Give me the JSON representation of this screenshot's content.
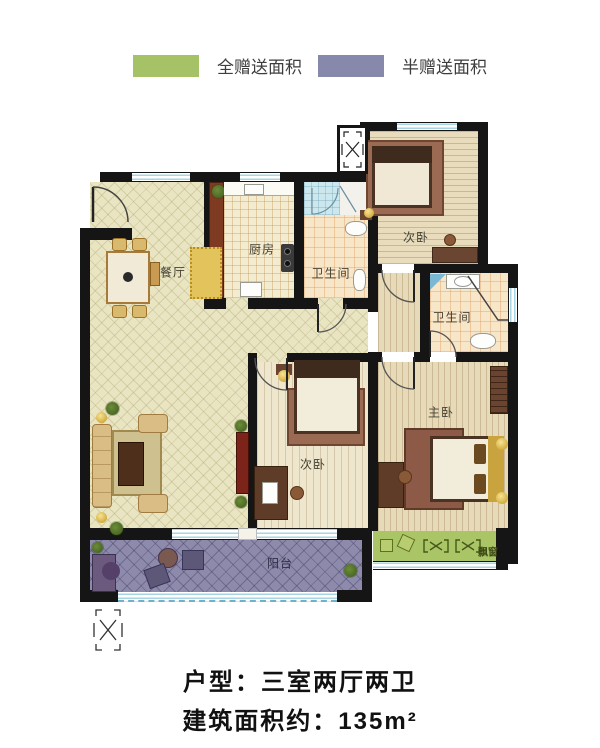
{
  "legend": {
    "items": [
      {
        "label": "全赠送面积",
        "color": "#a5c267"
      },
      {
        "label": "半赠送面积",
        "color": "#8689ac"
      }
    ]
  },
  "rooms": {
    "dining": {
      "label": "餐厅"
    },
    "kitchen": {
      "label": "厨房"
    },
    "bath1": {
      "label": "卫生间"
    },
    "bath2": {
      "label": "卫生间"
    },
    "bedroom_top": {
      "label": "次卧"
    },
    "bedroom_mid": {
      "label": "次卧"
    },
    "master": {
      "label": "主卧"
    },
    "balcony": {
      "label": "阳台"
    },
    "bay_window": {
      "label": "飘窗"
    }
  },
  "footer": {
    "line1": "户型：三室两厅两卫",
    "line2": "建筑面积约：135m²"
  },
  "colors": {
    "wall": "#151515",
    "legend_green": "#a5c267",
    "legend_purple": "#8689ac",
    "living_floor": "#e9e5c2",
    "balcony_floor": "#8d8aac",
    "bay_strip": "#a9c566",
    "window_glass": "#a9d4e3"
  }
}
